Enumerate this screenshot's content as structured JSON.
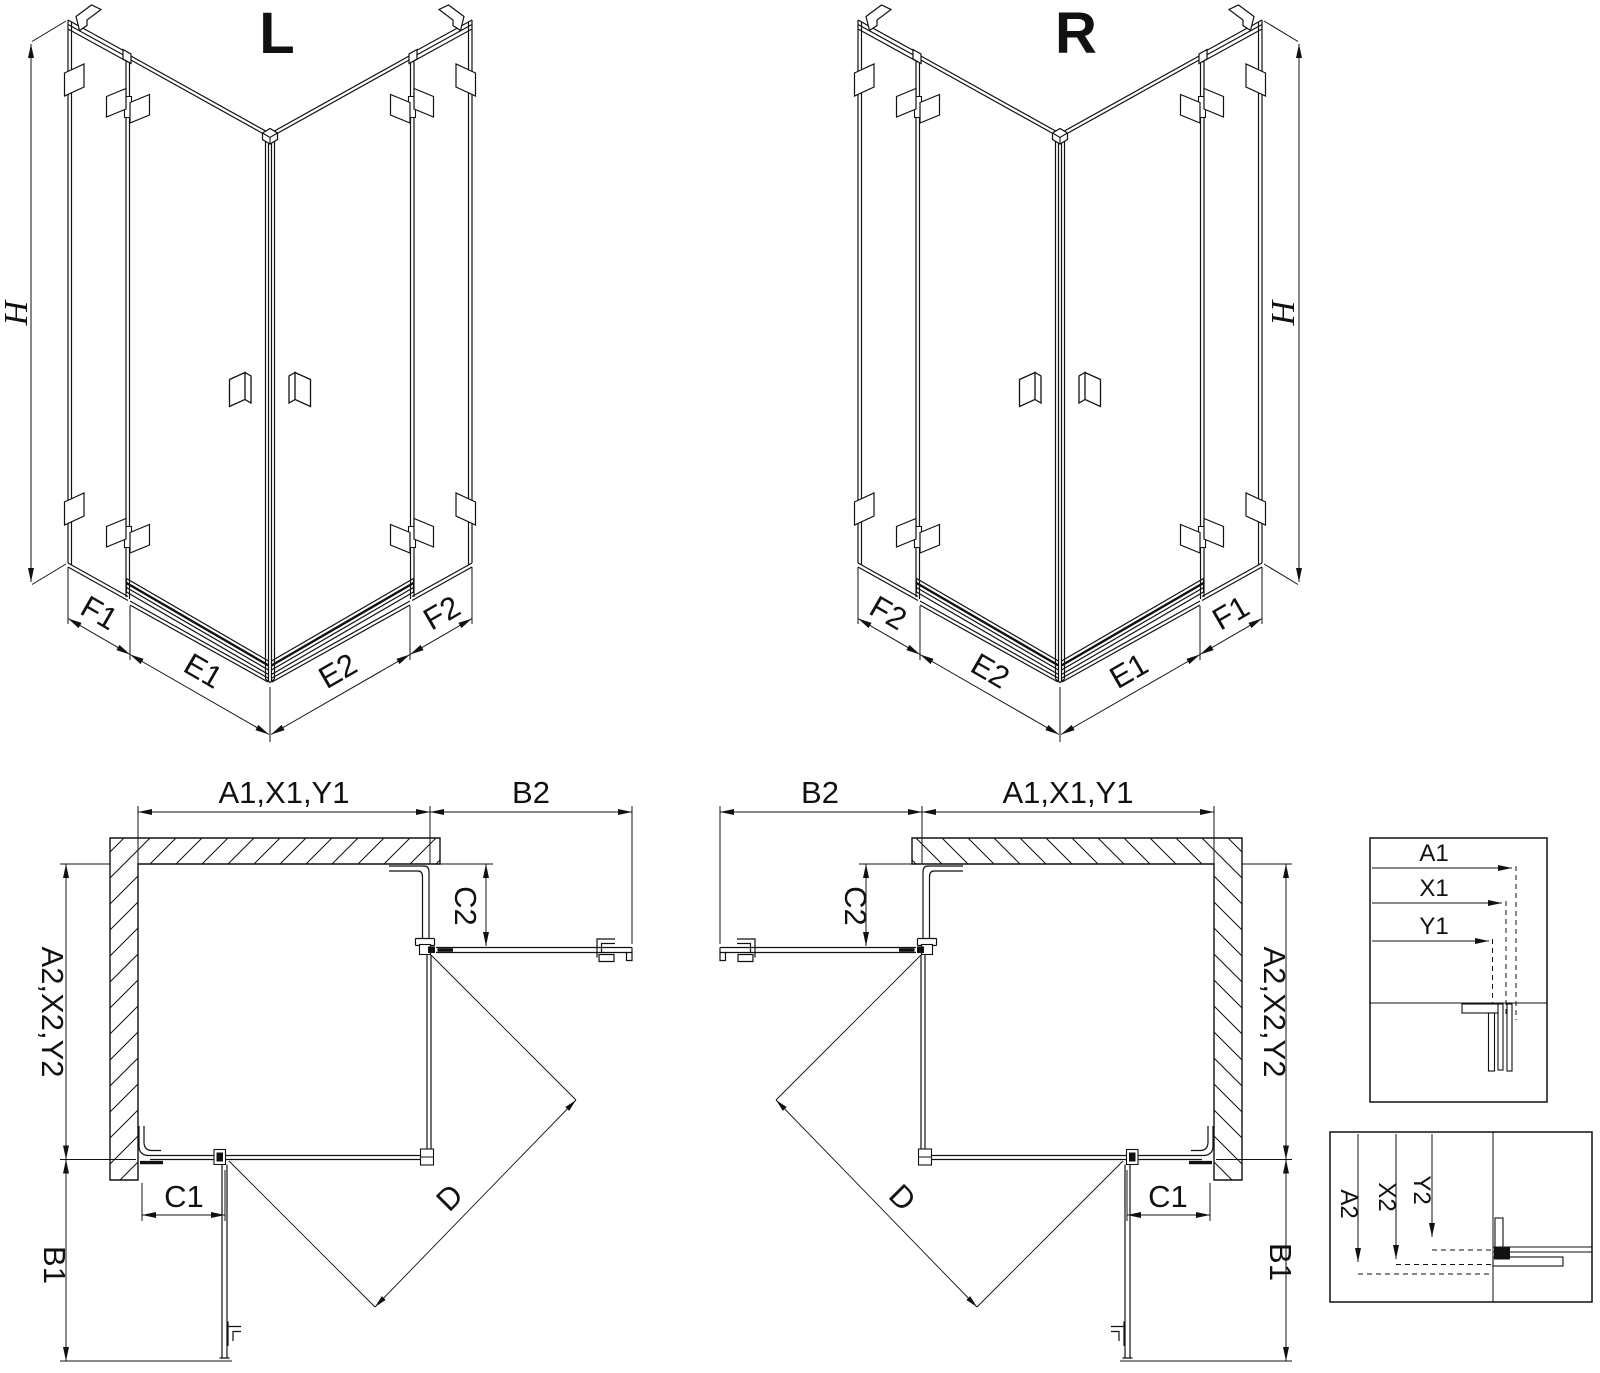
{
  "colors": {
    "ink": "#111111",
    "paper": "#ffffff"
  },
  "iso_left": {
    "title": "L",
    "height_dim": "H",
    "bottom_dims": {
      "left_fixed": "F1",
      "left_door": "E1",
      "right_door": "E2",
      "right_fixed": "F2"
    }
  },
  "iso_right": {
    "title": "R",
    "height_dim": "H",
    "bottom_dims": {
      "left_fixed": "F2",
      "left_door": "E2",
      "right_door": "E1",
      "right_fixed": "F1"
    }
  },
  "plan_left": {
    "width_top": "A1,X1,Y1",
    "side_panel_top": "B2",
    "fixed_right": "C2",
    "depth_side": "A2,X2,Y2",
    "fixed_bottom": "C1",
    "side_panel_bottom": "B1",
    "entry_diagonal": "D"
  },
  "plan_right": {
    "width_top": "A1,X1,Y1",
    "side_panel_top": "B2",
    "fixed_left": "C2",
    "depth_side": "A2,X2,Y2",
    "fixed_bottom": "C1",
    "side_panel_bottom": "B1",
    "entry_diagonal": "D"
  },
  "detail_widths": {
    "row_a": "A1",
    "row_x": "X1",
    "row_y": "Y1"
  },
  "detail_depths": {
    "col_a": "A2",
    "col_x": "X2",
    "col_y": "Y2"
  }
}
